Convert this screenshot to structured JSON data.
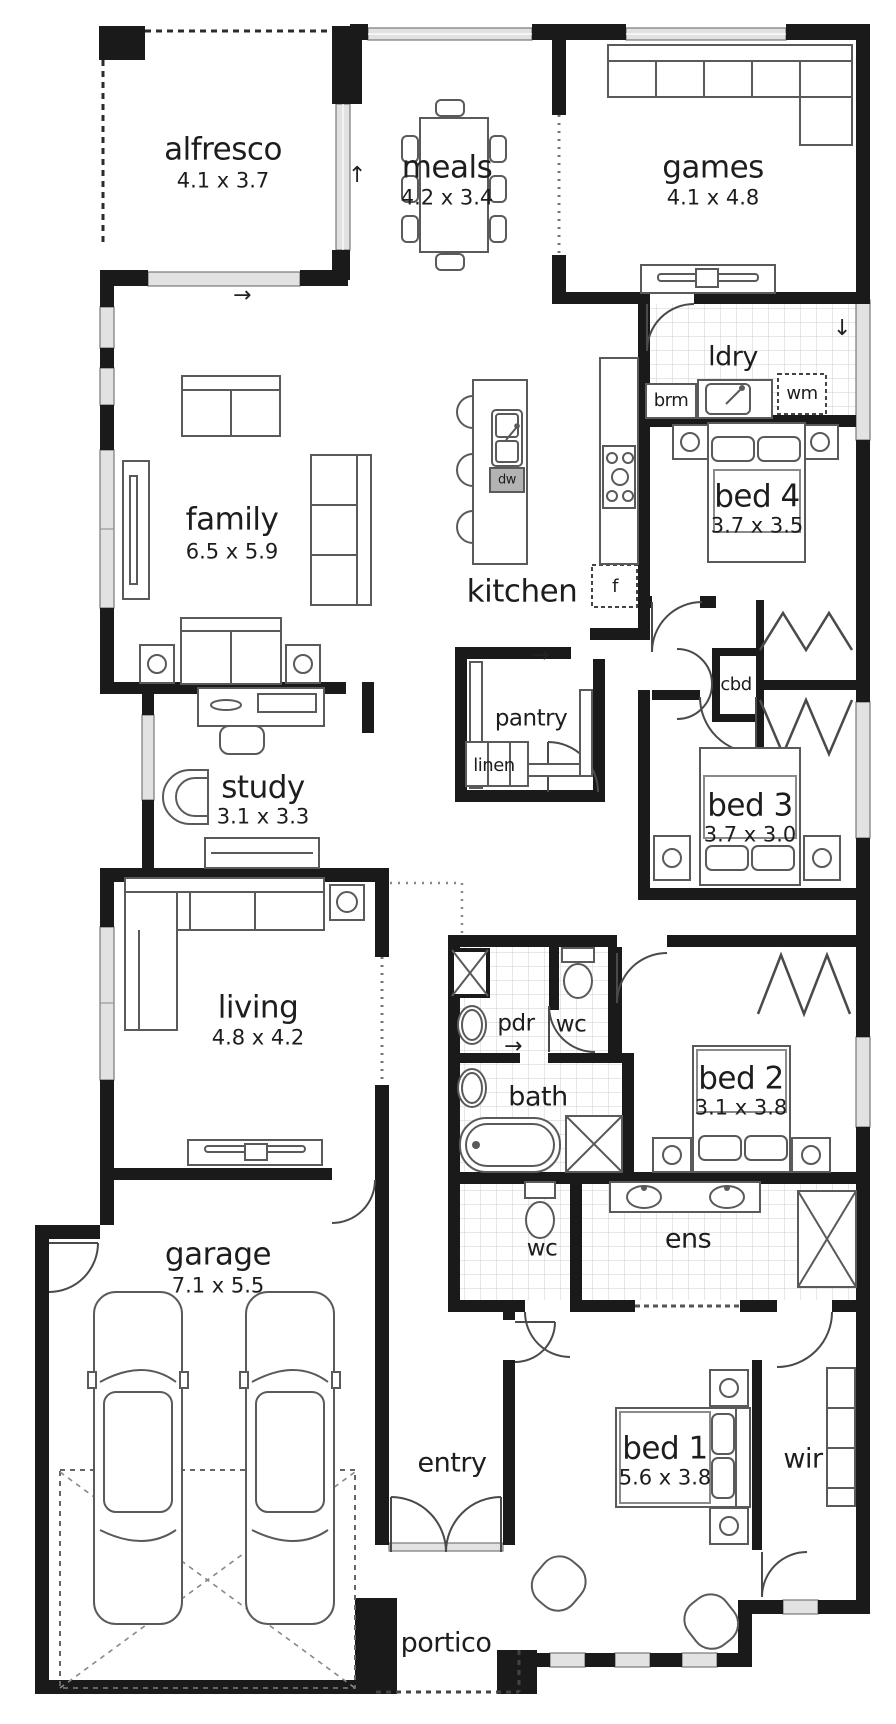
{
  "plan": {
    "rooms": {
      "alfresco": {
        "name": "alfresco",
        "dims": "4.1 x 3.7"
      },
      "meals": {
        "name": "meals",
        "dims": "4.2 x 3.4"
      },
      "games": {
        "name": "games",
        "dims": "4.1 x 4.8"
      },
      "laundry": {
        "name": "ldry"
      },
      "bed4": {
        "name": "bed 4",
        "dims": "3.7 x 3.5"
      },
      "family": {
        "name": "family",
        "dims": "6.5 x 5.9"
      },
      "kitchen": {
        "name": "kitchen"
      },
      "pantry": {
        "name": "pantry"
      },
      "linen": {
        "name": "linen"
      },
      "cupboard": {
        "name": "cbd"
      },
      "bed3": {
        "name": "bed 3",
        "dims": "3.7 x 3.0"
      },
      "study": {
        "name": "study",
        "dims": "3.1 x 3.3"
      },
      "living": {
        "name": "living",
        "dims": "4.8 x 4.2"
      },
      "powder": {
        "name": "pdr"
      },
      "wc": {
        "name": "wc"
      },
      "bath": {
        "name": "bath"
      },
      "bed2": {
        "name": "bed 2",
        "dims": "3.1 x 3.8"
      },
      "garage": {
        "name": "garage",
        "dims": "7.1 x 5.5"
      },
      "wc2": {
        "name": "wc"
      },
      "ensuite": {
        "name": "ens"
      },
      "entry": {
        "name": "entry"
      },
      "bed1": {
        "name": "bed 1",
        "dims": "5.6 x 3.8"
      },
      "wir": {
        "name": "wir"
      },
      "portico": {
        "name": "portico"
      }
    },
    "appliances": {
      "broom": "brm",
      "washing_machine": "wm",
      "fridge": "f",
      "dishwasher": "dw"
    },
    "arrows": {
      "up": "↑",
      "right": "→",
      "down": "↓"
    },
    "colors": {
      "wall": "#1a1a1a",
      "window_fill": "#e2e2e2",
      "tile_line": "#cfcfcf",
      "background": "#ffffff",
      "furniture_line": "#5a5a5a"
    }
  }
}
